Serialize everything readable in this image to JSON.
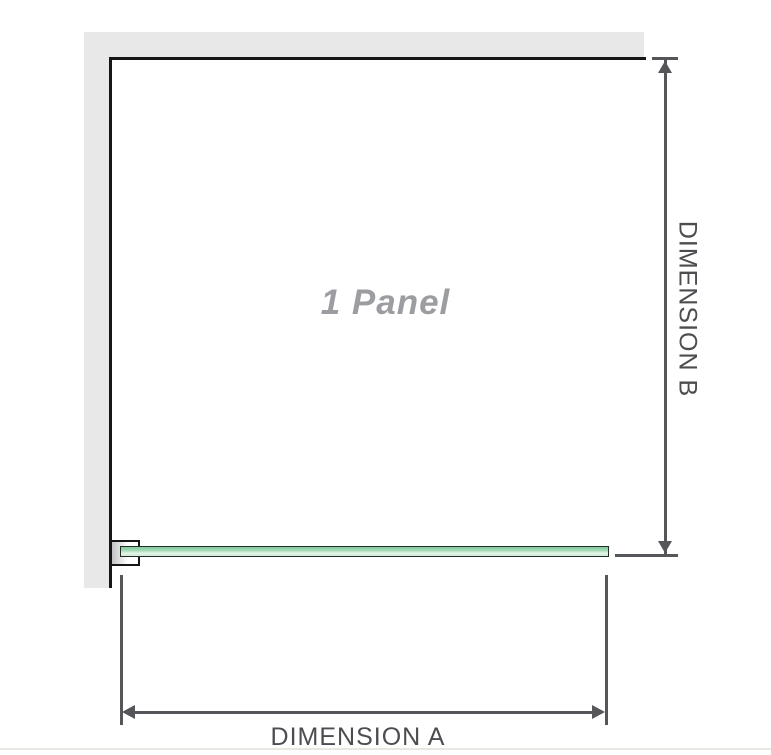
{
  "diagram": {
    "panel_label": "1 Panel",
    "dimension_a_label": "DIMENSION A",
    "dimension_b_label": "DIMENSION B"
  },
  "colors": {
    "bg": "#ffffff",
    "wall": "#e8e8e8",
    "outline": "#161616",
    "dim": "#54565a",
    "dim-text": "#4b4d50",
    "panel-label": "#9b9da0",
    "glass-dark": "#84caa0",
    "glass-light": "#e6f5ea",
    "glass-border": "#222e24",
    "rule": "#eae7e3"
  }
}
